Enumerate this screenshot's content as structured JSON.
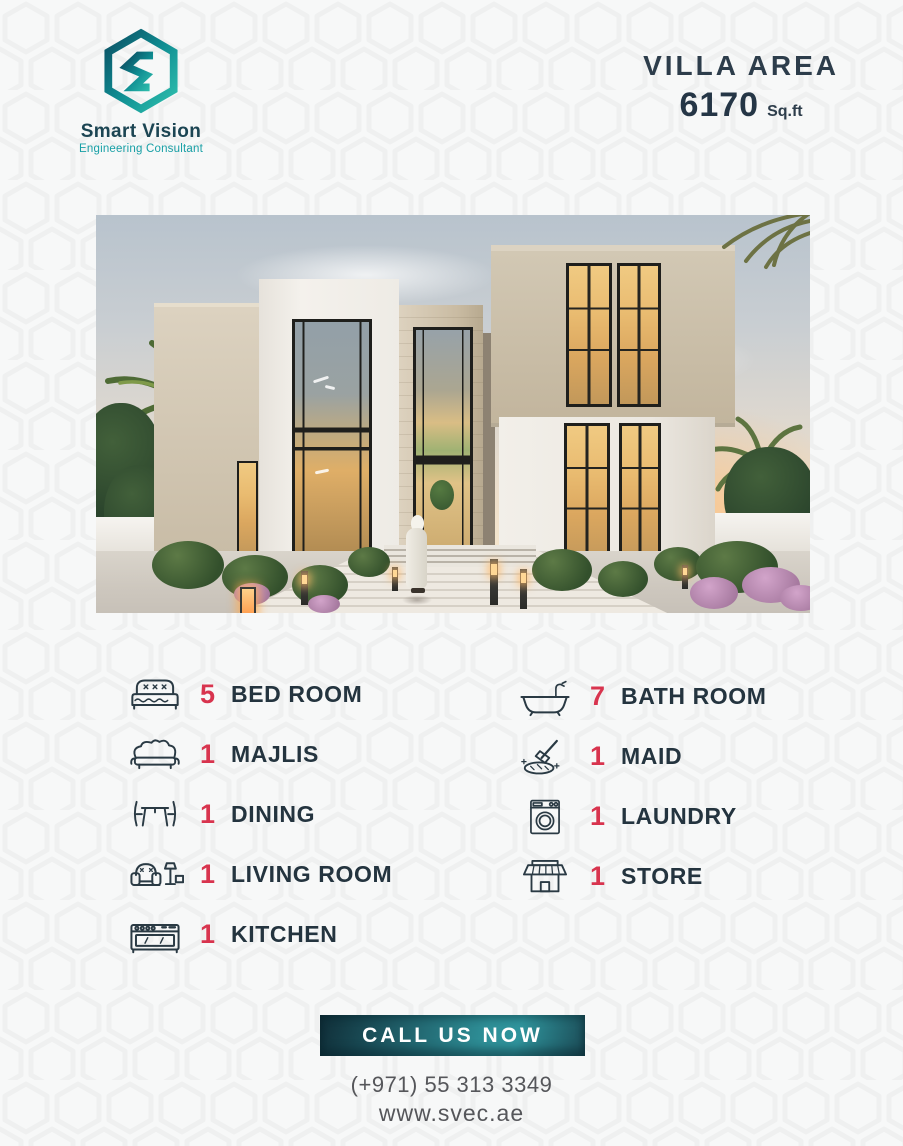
{
  "brand": {
    "name": "Smart Vision",
    "tagline": "Engineering Consultant",
    "logo_icon": "hexagon-s-logo"
  },
  "villa_area": {
    "label": "VILLA AREA",
    "value": "6170",
    "unit": "Sq.ft"
  },
  "image": {
    "description": "3D render of a modern two-storey villa at dusk: beige and white volumes, tall black-framed windows with golden sunset reflections, palm trees, white perimeter wall, landscaped walkway with bollard lights and a person in a white kandura walking to the entrance"
  },
  "features": {
    "left": [
      {
        "count": "5",
        "label": "BED ROOM",
        "icon": "bed-icon"
      },
      {
        "count": "1",
        "label": "MAJLIS",
        "icon": "sofa-icon"
      },
      {
        "count": "1",
        "label": "DINING",
        "icon": "dining-table-icon"
      },
      {
        "count": "1",
        "label": "LIVING ROOM",
        "icon": "armchair-lamp-icon"
      },
      {
        "count": "1",
        "label": "KITCHEN",
        "icon": "stove-icon"
      }
    ],
    "right": [
      {
        "count": "7",
        "label": "BATH ROOM",
        "icon": "bathtub-icon"
      },
      {
        "count": "1",
        "label": "MAID",
        "icon": "cleaning-icon"
      },
      {
        "count": "1",
        "label": "LAUNDRY",
        "icon": "washing-machine-icon"
      },
      {
        "count": "1",
        "label": "STORE",
        "icon": "storefront-icon"
      }
    ]
  },
  "cta": {
    "label": "CALL US NOW"
  },
  "contact": {
    "phone": "(+971) 55 313 3349",
    "website": "www.svec.ae"
  },
  "colors": {
    "accent_red": "#d8344e",
    "dark_navy": "#24343f",
    "teal": "#18a0a6",
    "button_gradient_dark": "#102e38",
    "button_gradient_light": "#2f949c",
    "background": "#f7f8f8"
  }
}
